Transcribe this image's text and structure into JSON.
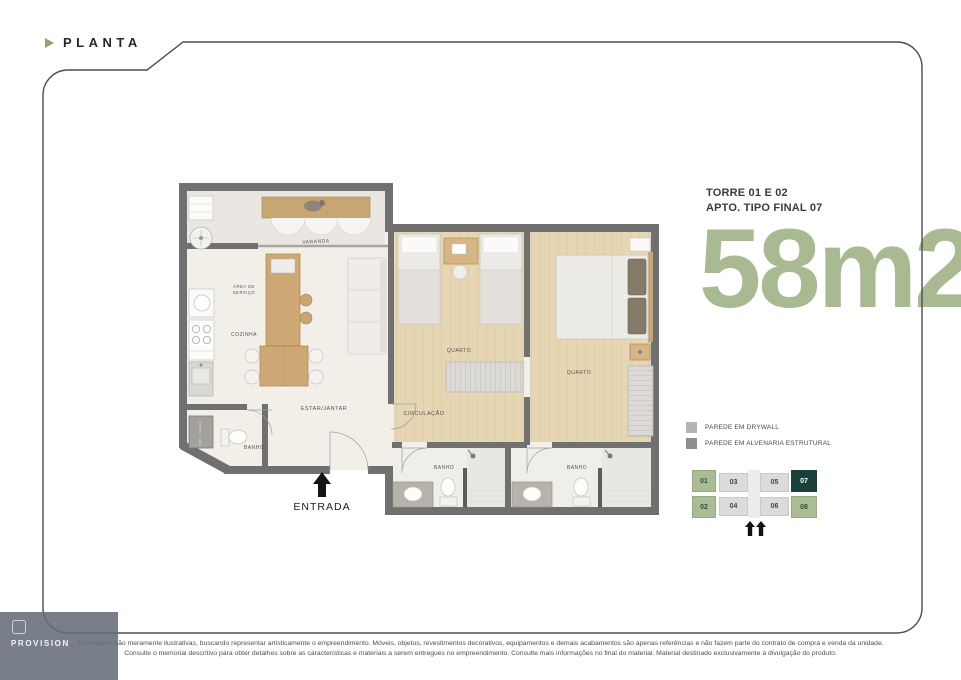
{
  "header": {
    "label": "PLANTA",
    "arrow_color": "#93a272"
  },
  "unit_info": {
    "tower": "TORRE 01 E 02",
    "type": "APTO. TIPO FINAL 07",
    "area": "58m2,",
    "area_color": "#a9ba92"
  },
  "legend": {
    "items": [
      {
        "label": "PAREDE EM DRYWALL",
        "color": "#b4b4b2"
      },
      {
        "label": "PAREDE EM ALVENARIA ESTRUTURAL",
        "color": "#8e8e8c"
      }
    ]
  },
  "keyplan": {
    "highlight": "07",
    "colors": {
      "green": "#a9bd94",
      "gray": "#dbdbd9",
      "dark": "#17413a"
    },
    "units": [
      {
        "id": "01",
        "style": "green"
      },
      {
        "id": "02",
        "style": "green"
      },
      {
        "id": "03",
        "style": "gray"
      },
      {
        "id": "04",
        "style": "gray"
      },
      {
        "id": "05",
        "style": "gray"
      },
      {
        "id": "06",
        "style": "gray"
      },
      {
        "id": "07",
        "style": "dark"
      },
      {
        "id": "08",
        "style": "green"
      }
    ]
  },
  "floor_plan": {
    "wall_color": "#707070",
    "entrance": "ENTRADA",
    "shaft": "PROJ. SANCA",
    "rooms": {
      "varanda": "VARANDA",
      "servico_1": "ÁREA DE",
      "servico_2": "SERVIÇO",
      "cozinha": "COZINHA",
      "estar_jantar": "ESTAR/JANTAR",
      "banho_social": "BANHO",
      "circulacao": "CIRCULAÇÃO",
      "quarto_1": "QUARTO",
      "quarto_2": "QUARTO",
      "banho_1": "BANHO",
      "banho_2": "BANHO"
    }
  },
  "watermark": {
    "label": "PROVISION"
  },
  "disclaimer": {
    "line1": "As imagens são meramente ilustrativas, buscando representar artisticamente o empreendimento. Móveis, objetos, revestimentos decorativos, equipamentos e demais acabamentos são apenas referências e não fazem parte do contrato de compra e venda da unidade.",
    "line2": "Consulte o memorial descritivo para obter detalhes sobre as características e materiais a serem entregues no empreendimento. Consulte mais informações no final do material. Material destinado exclusivamente à divulgação do produto."
  }
}
